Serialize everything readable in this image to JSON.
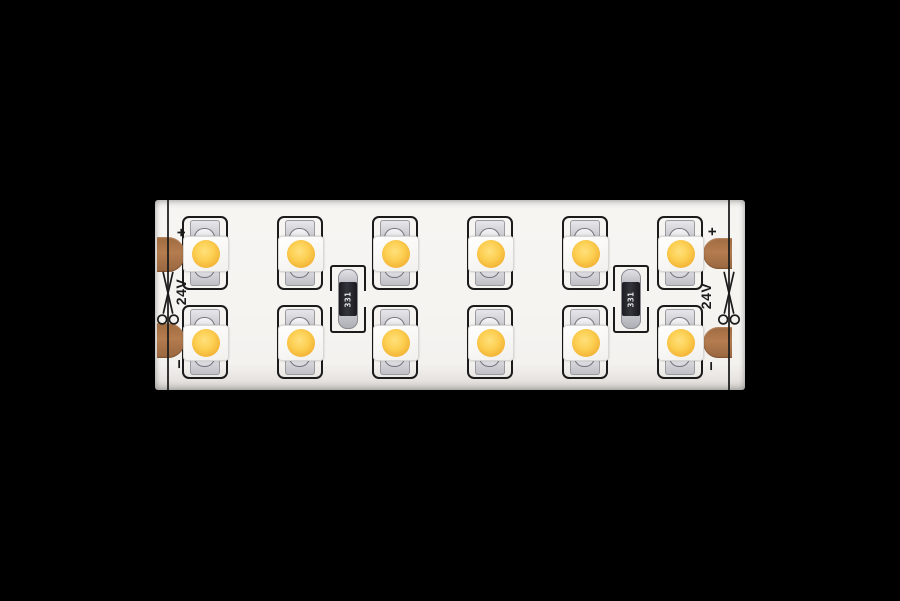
{
  "scene": {
    "subject": "Dual-row warm-white SMD LED strip segment photographed on a black background",
    "background_color": "#000000"
  },
  "strip": {
    "labels": {
      "voltage": "24V",
      "polarity_plus": "+",
      "polarity_minus": "−",
      "resistor_code": "331"
    },
    "led_grid": {
      "rows": 2,
      "columns": 6,
      "total_leds": 12
    },
    "resistor_count": 2,
    "solder_pad_count": 4,
    "icons": {
      "cut_mark": "scissors-icon"
    },
    "colors": {
      "pcb": "#f6f4f1",
      "copper_pad": "#b47c4f",
      "led_phosphor": "#f3b335",
      "silkscreen": "#1b1b1b",
      "solder_silver": "#c9c9cf",
      "resistor_body": "#34343c"
    }
  }
}
